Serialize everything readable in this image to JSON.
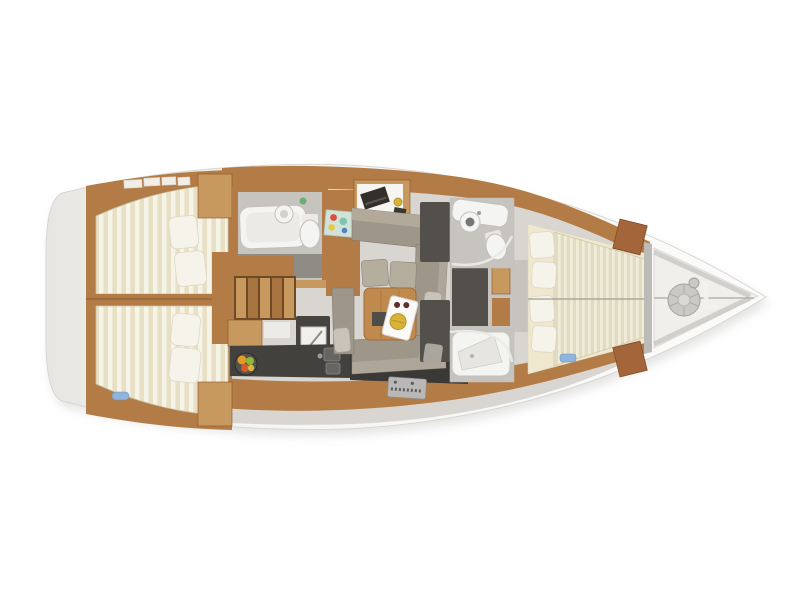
{
  "image": {
    "description": "Top-view interior floor plan of a sailing yacht: two aft double cabins with striped mattresses, aft head with bathtub, companionway stairs, galley with stove and fruit bowl, navigation desk, U-shaped salon sofa with wood table and serving tray, two forward heads with wardrobes, forward V-berth cabin with four pillows, and bow anchor locker with coiled rope.",
    "background": "#ffffff",
    "orientation": "bow-right-stern-left"
  },
  "palette": {
    "deck": "#f6f5f3",
    "deck_shade": "#e7e6e2",
    "hull_outline": "#d7d6d3",
    "shadow": "#a7a6a3",
    "floor": "#d9d6d1",
    "floor_mid": "#c7c4bf",
    "floor_dark": "#8f8c86",
    "wood": "#b37c47",
    "wood_light": "#c7995e",
    "wood_dark": "#855426",
    "wood_red": "#a4653a",
    "counter": "#43413d",
    "island": "#46443f",
    "plinth": "#3b3936",
    "wardrobe": "#534f4a",
    "sofa": "#9e9689",
    "sofa_light": "#b5ad9e",
    "cushion": "#c8c4ba",
    "mattress": "#e7e0c4",
    "mattress_stripe": "#f6f3e9",
    "mattress_fwd": "#e2dbbf",
    "mattress_fwd_stripe": "#efecd9",
    "pillow": "#f6f3ea",
    "bed_base": "#efe8cf",
    "fixture": "#f4f4f2",
    "fixture_line": "#c2c0bc",
    "table_wood": "#c08a4f",
    "tray": "#fbfaf8",
    "plate_gold": "#d9b23a",
    "fruit_orange": "#e09b28",
    "fruit_green": "#8db832",
    "fruit_red": "#d95b2b",
    "accent_blue": "#8fb4dd",
    "rope": "#cbc9c4",
    "steel": "#b9b8b6",
    "chart_teal": "#7fc4b1",
    "chart_red": "#d94f3d",
    "chart_yellow": "#e8c83f",
    "chart_blue": "#4f83c4"
  },
  "regions": [
    {
      "id": "aft-cabin-port",
      "label": "aft double cabin (port)"
    },
    {
      "id": "aft-cabin-starboard",
      "label": "aft double cabin (starboard)"
    },
    {
      "id": "aft-head",
      "label": "aft bathroom with tub"
    },
    {
      "id": "companionway-stairs",
      "label": "companionway steps"
    },
    {
      "id": "galley",
      "label": "galley with stove, sinks and fruit bowl"
    },
    {
      "id": "nav-station",
      "label": "navigation desk"
    },
    {
      "id": "salon",
      "label": "salon with U-sofa and table"
    },
    {
      "id": "fwd-head-port",
      "label": "forward bathroom (port)"
    },
    {
      "id": "fwd-head-starboard",
      "label": "forward shower room (starboard)"
    },
    {
      "id": "forward-cabin",
      "label": "forward V-berth cabin"
    },
    {
      "id": "bow-locker",
      "label": "anchor locker with rope coil"
    }
  ]
}
